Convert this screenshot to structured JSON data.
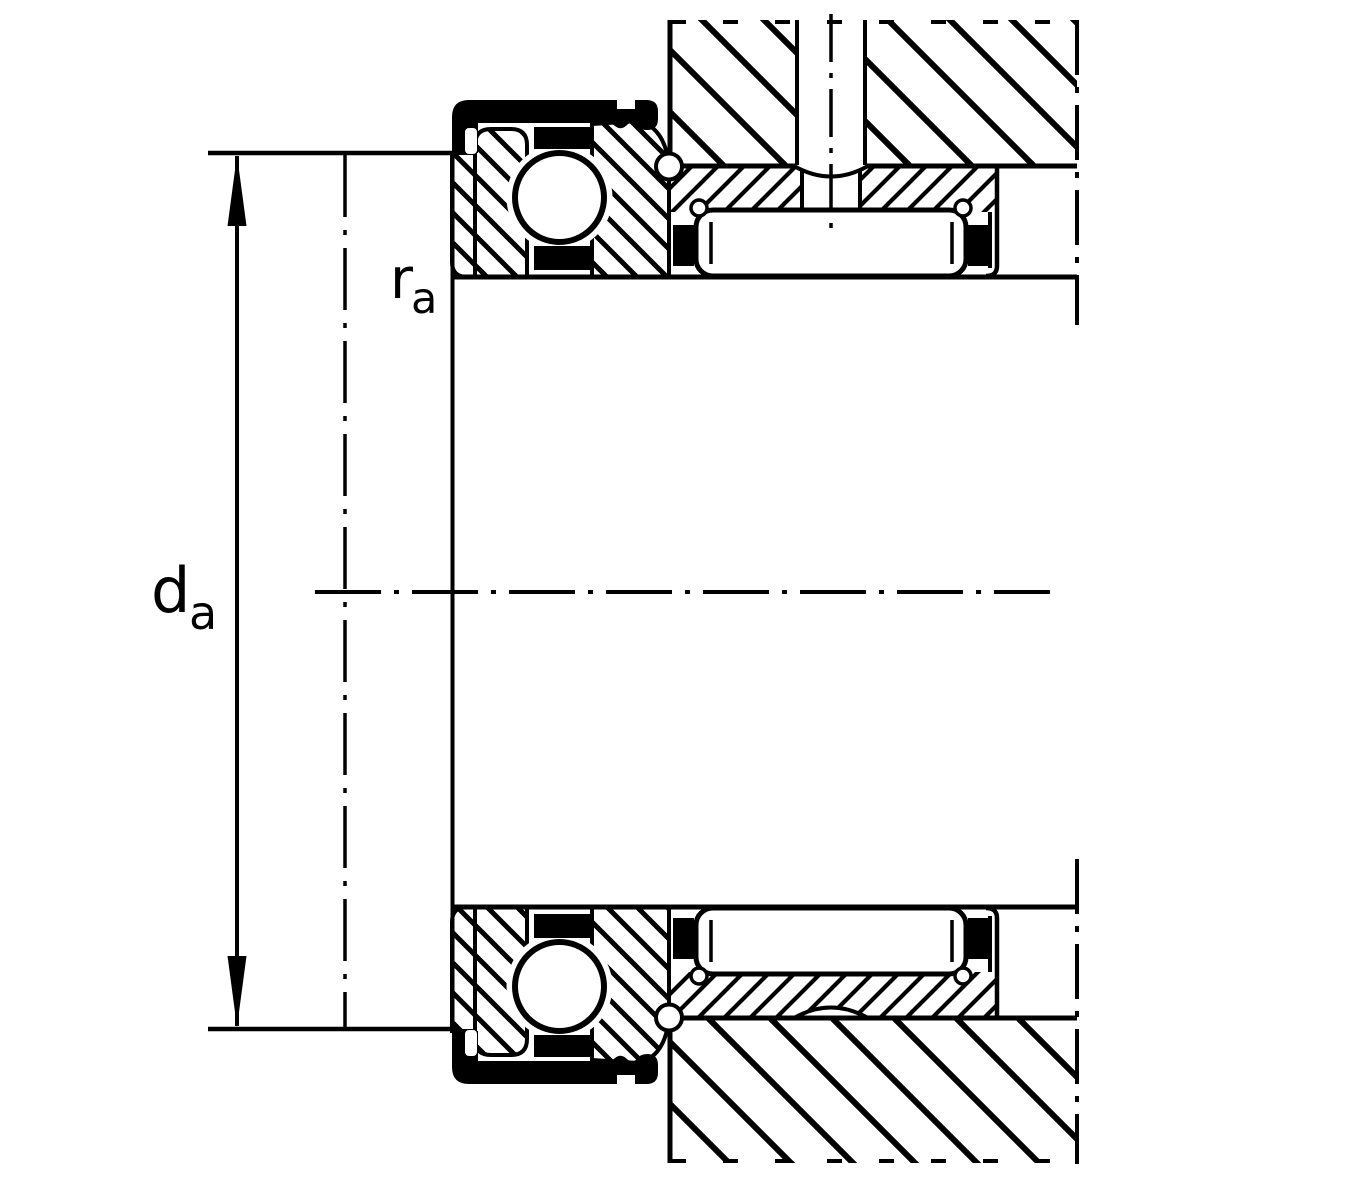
{
  "diagram": {
    "description": "Engineering cross-section drawing of a combined needle roller and ball bearing mounted in a housing, with abutment dimension annotations",
    "colors": {
      "line": "#000000",
      "background": "#ffffff"
    },
    "labels": {
      "abutment_diameter": {
        "symbol": "d",
        "subscript": "a"
      },
      "fillet_radius": {
        "symbol": "r",
        "subscript": "a"
      }
    }
  }
}
